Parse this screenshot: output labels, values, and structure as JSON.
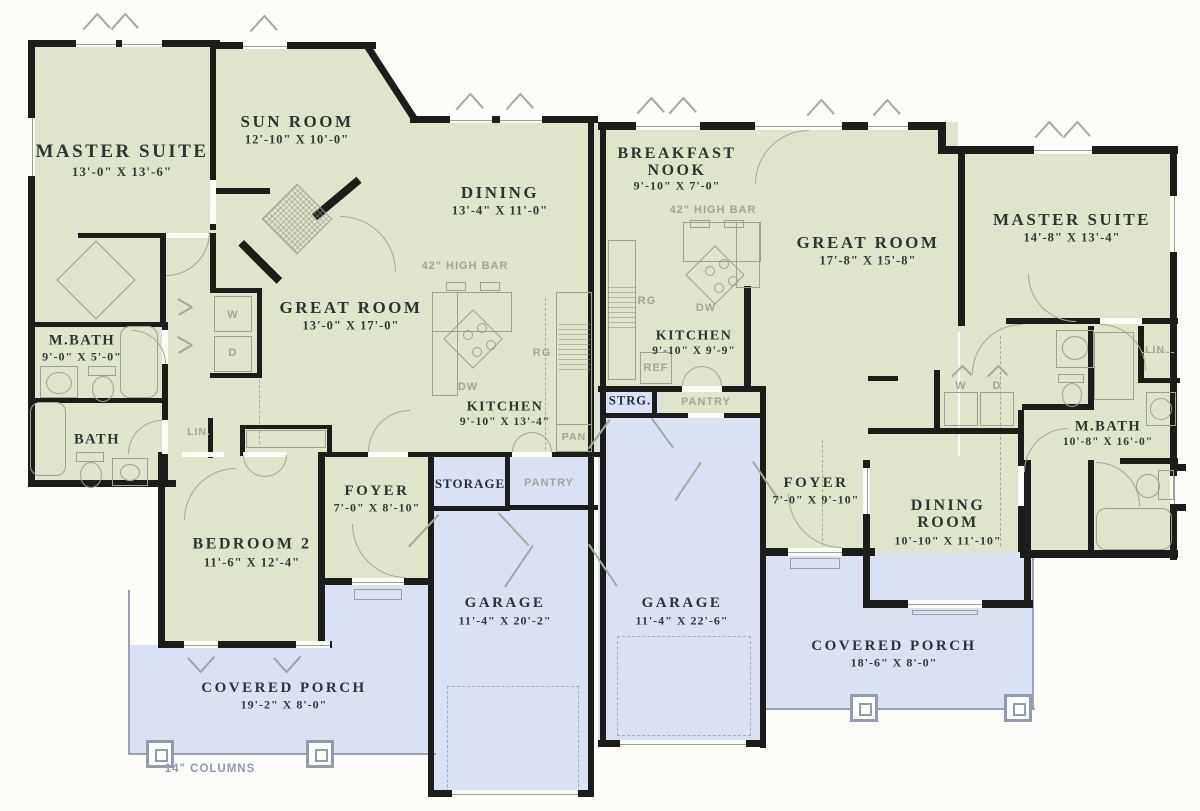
{
  "colors": {
    "room_fill": "#dfe5ca",
    "garage_porch_fill": "#d9e1f2",
    "wall": "#1c1c1a",
    "label_dark": "#2b3436",
    "label_gray": "#a2a796",
    "porch_gray": "#8f9ab3"
  },
  "left": {
    "master": {
      "name": "MASTER SUITE",
      "dims": "13'-0\" X 13'-6\""
    },
    "sunroom": {
      "name": "SUN ROOM",
      "dims": "12'-10\" X 10'-0\""
    },
    "dining": {
      "name": "DINING",
      "dims": "13'-4\" X 11'-0\""
    },
    "great": {
      "name": "GREAT ROOM",
      "dims": "13'-0\" X 17'-0\""
    },
    "mbath": {
      "name": "M.BATH",
      "dims": "9'-0\" X 5'-0\""
    },
    "bath": {
      "name": "BATH"
    },
    "kitchen": {
      "name": "KITCHEN",
      "dims": "9'-10\" X 13'-4\""
    },
    "bed2": {
      "name": "BEDROOM 2",
      "dims": "11'-6\" X 12'-4\""
    },
    "foyer": {
      "name": "FOYER",
      "dims": "7'-0\" X 8'-10\""
    },
    "storage": {
      "name": "STORAGE"
    },
    "garage": {
      "name": "GARAGE",
      "dims": "11'-4\" X 20'-2\""
    },
    "porch": {
      "name": "COVERED PORCH",
      "dims": "19'-2\" X 8'-0\""
    },
    "high_bar": "42\" HIGH BAR",
    "lin": "LIN.",
    "w": "W",
    "d": "D",
    "rg": "RG",
    "dw": "DW",
    "pan": "PAN",
    "pantry": "PANTRY",
    "columns_note": "14\" COLUMNS"
  },
  "right": {
    "breakfast": {
      "name": "BREAKFAST NOOK",
      "dims": "9'-10\" X 7'-0\""
    },
    "great": {
      "name": "GREAT ROOM",
      "dims": "17'-8\" X 15'-8\""
    },
    "master": {
      "name": "MASTER SUITE",
      "dims": "14'-8\" X 13'-4\""
    },
    "kitchen": {
      "name": "KITCHEN",
      "dims": "9'-10\" X 9'-9\""
    },
    "mbath": {
      "name": "M.BATH",
      "dims": "10'-8\" X 16'-0\""
    },
    "foyer": {
      "name": "FOYER",
      "dims": "7'-0\" X 9'-10\""
    },
    "dining": {
      "name": "DINING ROOM",
      "dims": "10'-10\" X 11'-10\""
    },
    "strg": "STRG.",
    "garage": {
      "name": "GARAGE",
      "dims": "11'-4\" X 22'-6\""
    },
    "porch": {
      "name": "COVERED PORCH",
      "dims": "18'-6\" X 8'-0\""
    },
    "high_bar": "42\" HIGH BAR",
    "lin": "LIN.",
    "w": "W",
    "d": "D",
    "rg": "RG",
    "dw": "DW",
    "ref": "REF",
    "pantry": "PANTRY"
  }
}
